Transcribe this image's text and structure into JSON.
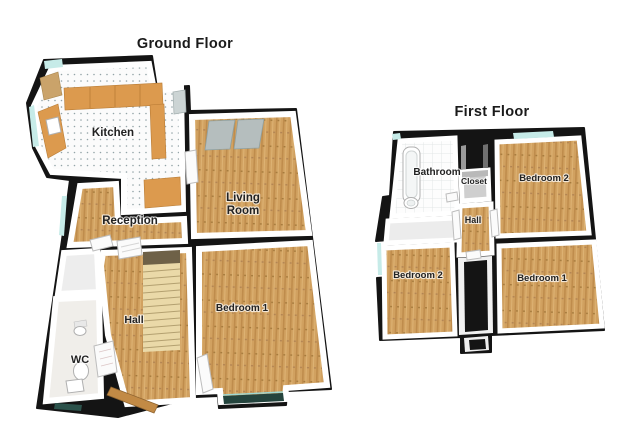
{
  "ground_floor": {
    "title": "Ground Floor",
    "rooms": {
      "kitchen": "Kitchen",
      "living_room": {
        "line1": "Living",
        "line2": "Room"
      },
      "reception": "Reception",
      "hall": "Hall",
      "wc": "WC",
      "bedroom1": "Bedroom 1"
    }
  },
  "first_floor": {
    "title": "First Floor",
    "rooms": {
      "bathroom": "Bathroom",
      "closet": "Closet",
      "bedroom2_top": "Bedroom 2",
      "hall": "Hall",
      "bedroom2_left": "Bedroom 2",
      "bedroom1": "Bedroom 1"
    }
  },
  "colors": {
    "wall": "#141414",
    "wood": "#d1a160",
    "window_glass": "#c6ebe8",
    "bay_glass": "#24443d",
    "counter": "#dc9a4e",
    "stairs": "#ead9a8",
    "stairs_landing": "#6e6147",
    "wardrobe_panel": "#b5bebe"
  }
}
